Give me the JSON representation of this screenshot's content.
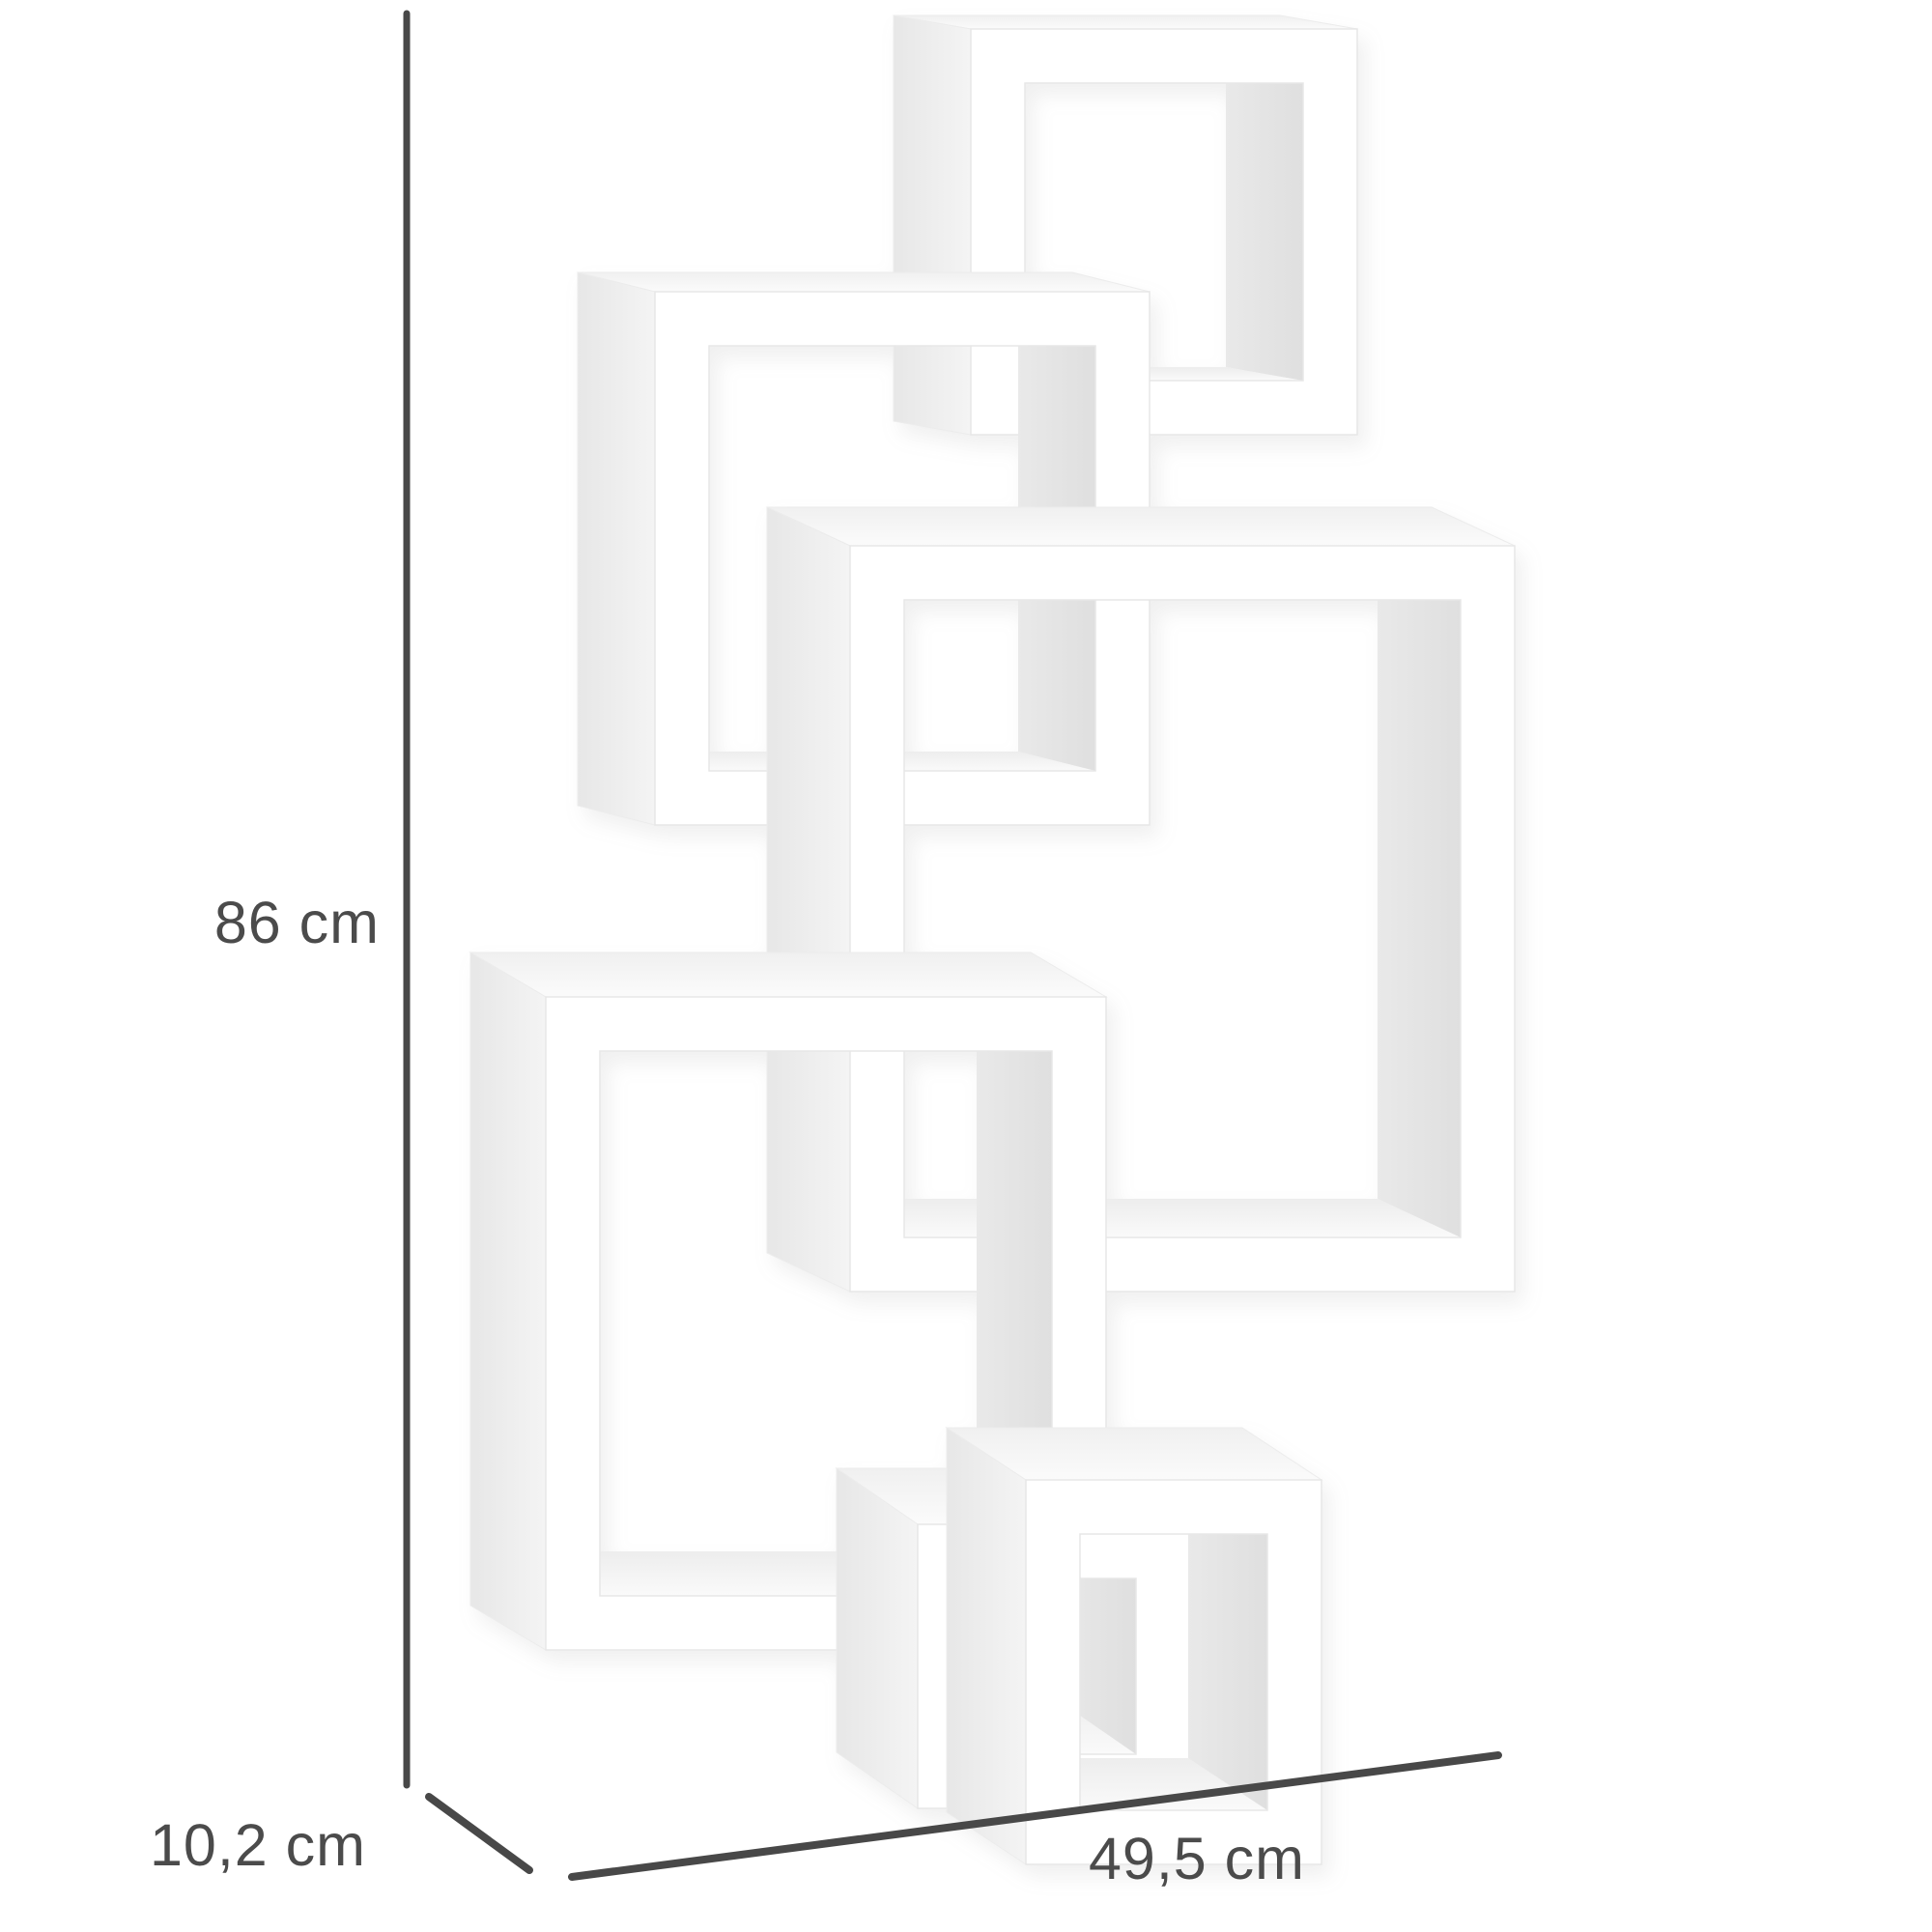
{
  "diagram": {
    "product_name": "interlocking-cubes-wall-shelf",
    "cube_count": 6,
    "shelf_color": "#ffffff",
    "background_color": "#ffffff",
    "annotation": {
      "line_color": "#484848",
      "text_color": "#4b4b4b",
      "height_label": "86 cm",
      "depth_label": "10,2 cm",
      "width_label": "49,5 cm"
    }
  }
}
